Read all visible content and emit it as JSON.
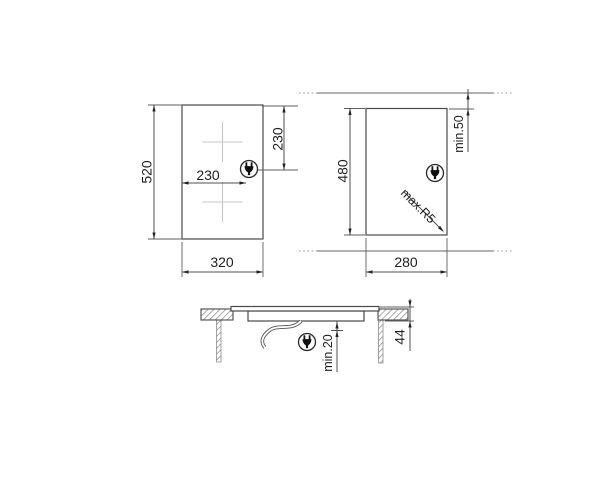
{
  "drawing": {
    "title": "hob-installation-dimensions",
    "top_view": {
      "height_mm": "520",
      "width_mm": "320",
      "plug_from_left_mm": "230",
      "plug_from_top_mm": "230"
    },
    "cutout_view": {
      "height_mm": "480",
      "width_mm": "280",
      "rear_clearance": "min.50",
      "corner_radius": "max.R5"
    },
    "section_view": {
      "hob_height_mm": "44",
      "bottom_clearance": "min.20"
    },
    "icons": {
      "power_plug": "power-plug-icon"
    },
    "colors": {
      "background": "#ffffff",
      "outline": "#4a4a4a",
      "dimension": "#4f4f4f",
      "text": "#1f1f1f",
      "zone_cross": "#c6c6c6",
      "hatch": "#8f8f8f"
    }
  }
}
